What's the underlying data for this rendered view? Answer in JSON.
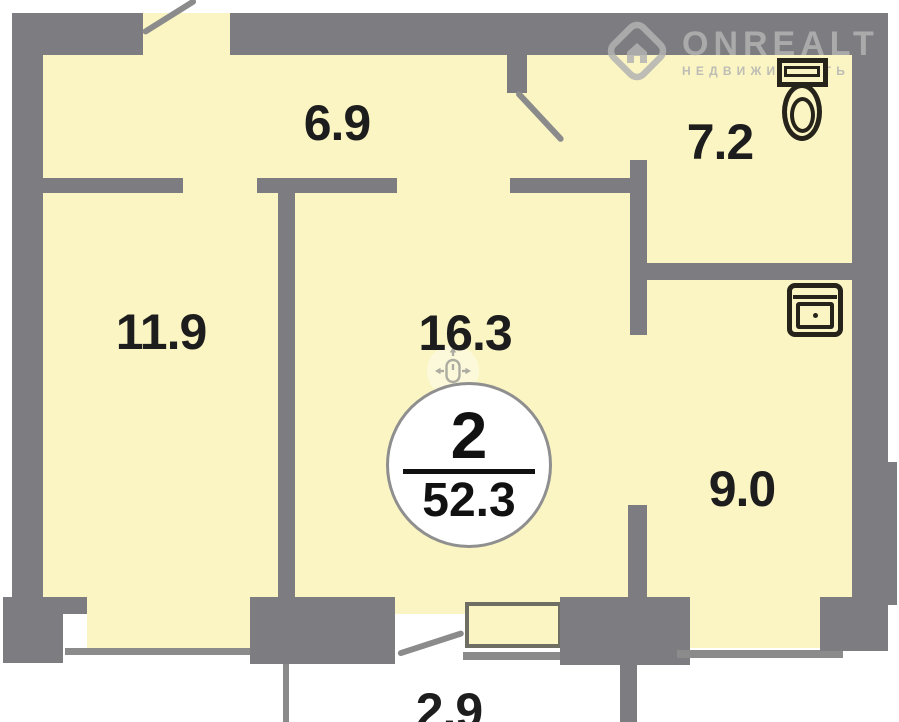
{
  "plan": {
    "badge": {
      "rooms": "2",
      "area": "52.3"
    },
    "room_labels": {
      "hallway": "6.9",
      "bathroom": "7.2",
      "bedroom": "11.9",
      "living_room": "16.3",
      "kitchen": "9.0",
      "balcony": "2.9"
    },
    "icons": {
      "toilet": "toilet-icon",
      "sink": "sink-icon",
      "pan": "pan-drag-icon"
    }
  },
  "watermark": {
    "brand": "ONREALT",
    "tagline": "НЕДВИЖИМОСТЬ"
  },
  "colors": {
    "room_fill": "#FAF5C2",
    "wall": "#7D7D81",
    "thin_line": "#8B8B8B",
    "fixture_stroke": "#26231B",
    "label_text": "#1D1D1D",
    "badge_border": "#8F8F8F",
    "watermark_gray": "#B3B3B3",
    "background": "#FFFFFF"
  }
}
